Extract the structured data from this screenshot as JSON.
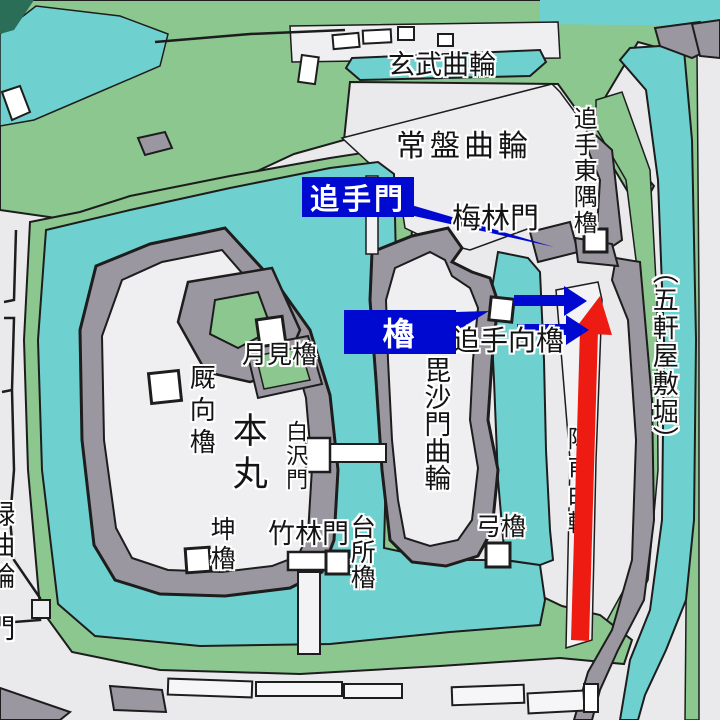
{
  "areas": {
    "genbu_kuruwa": "玄武曲輪",
    "tokiwa_kuruwa": "常盤曲輪",
    "bishamon_kuruwa": "毘沙門曲輪",
    "honmaru": "本丸",
    "jinpo_kuruwa": "陣甫曲輪",
    "midori_kuruwa": "緑曲輪",
    "goken_yashiki_bori": "（五軒屋敷堀）"
  },
  "gates": {
    "bairin_mon": "梅林門",
    "shirasawa_mon": "白沢門",
    "chikurin_mon": "竹林門",
    "partial_gate": "門"
  },
  "towers": {
    "ote_higashi_sumi_yagura": "追手東隅櫓",
    "ote_mukai_yagura": "追手向櫓",
    "tsukimi_yagura": "月見櫓",
    "umaya_mukai_yagura": "厩向櫓",
    "hitsujisaru_yagura": "坤櫓",
    "daidokoro_yagura": "台所櫓",
    "yumi_yagura": "弓櫓"
  },
  "callouts": {
    "ote_mon": "追手門",
    "yagura": "櫓"
  },
  "colors": {
    "water": "#6fd1cf",
    "bank_green": "#8bc78e",
    "ground": "#eae9ec",
    "wall_gray": "#9b97a0",
    "outline": "#1d1d1d",
    "callout_blue": "#0009d0",
    "arrow_blue": "#0009d0",
    "arrow_red": "#ee1b12",
    "dark_corner": "#2a6e58"
  }
}
